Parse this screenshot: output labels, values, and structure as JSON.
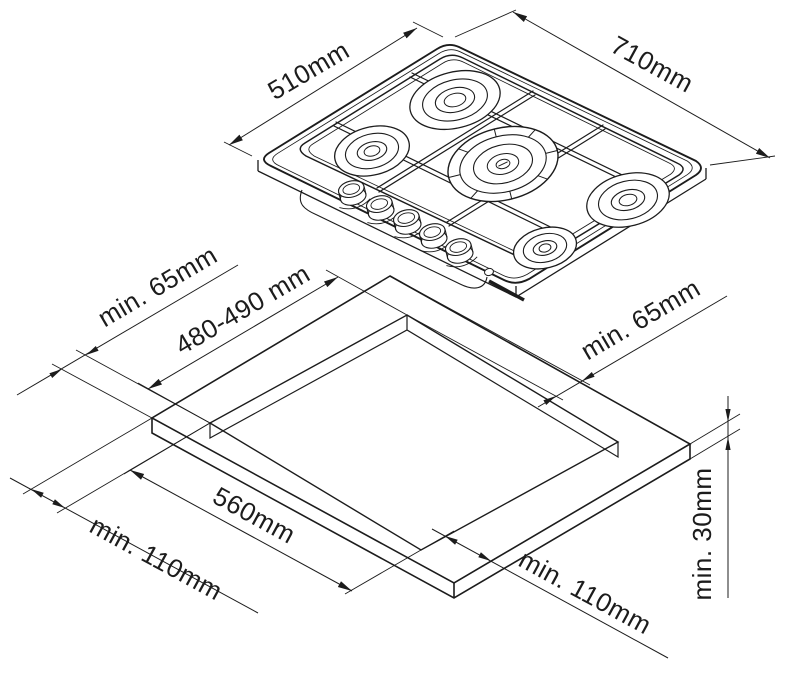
{
  "page": {
    "background": "#ffffff",
    "line_color": "#1c1c1c"
  },
  "hob": {
    "burner_count": 5,
    "knob_count": 5,
    "dimensions": {
      "depth": "510mm",
      "width": "710mm"
    }
  },
  "cutout": {
    "dimensions": {
      "depth": "480-490 mm",
      "width": "560mm",
      "clearance_rear_left": "min. 65mm",
      "clearance_rear_right": "min. 65mm",
      "clearance_front_left": "min. 110mm",
      "clearance_front_right": "min. 110mm",
      "worktop_thickness": "min. 30mm"
    }
  }
}
